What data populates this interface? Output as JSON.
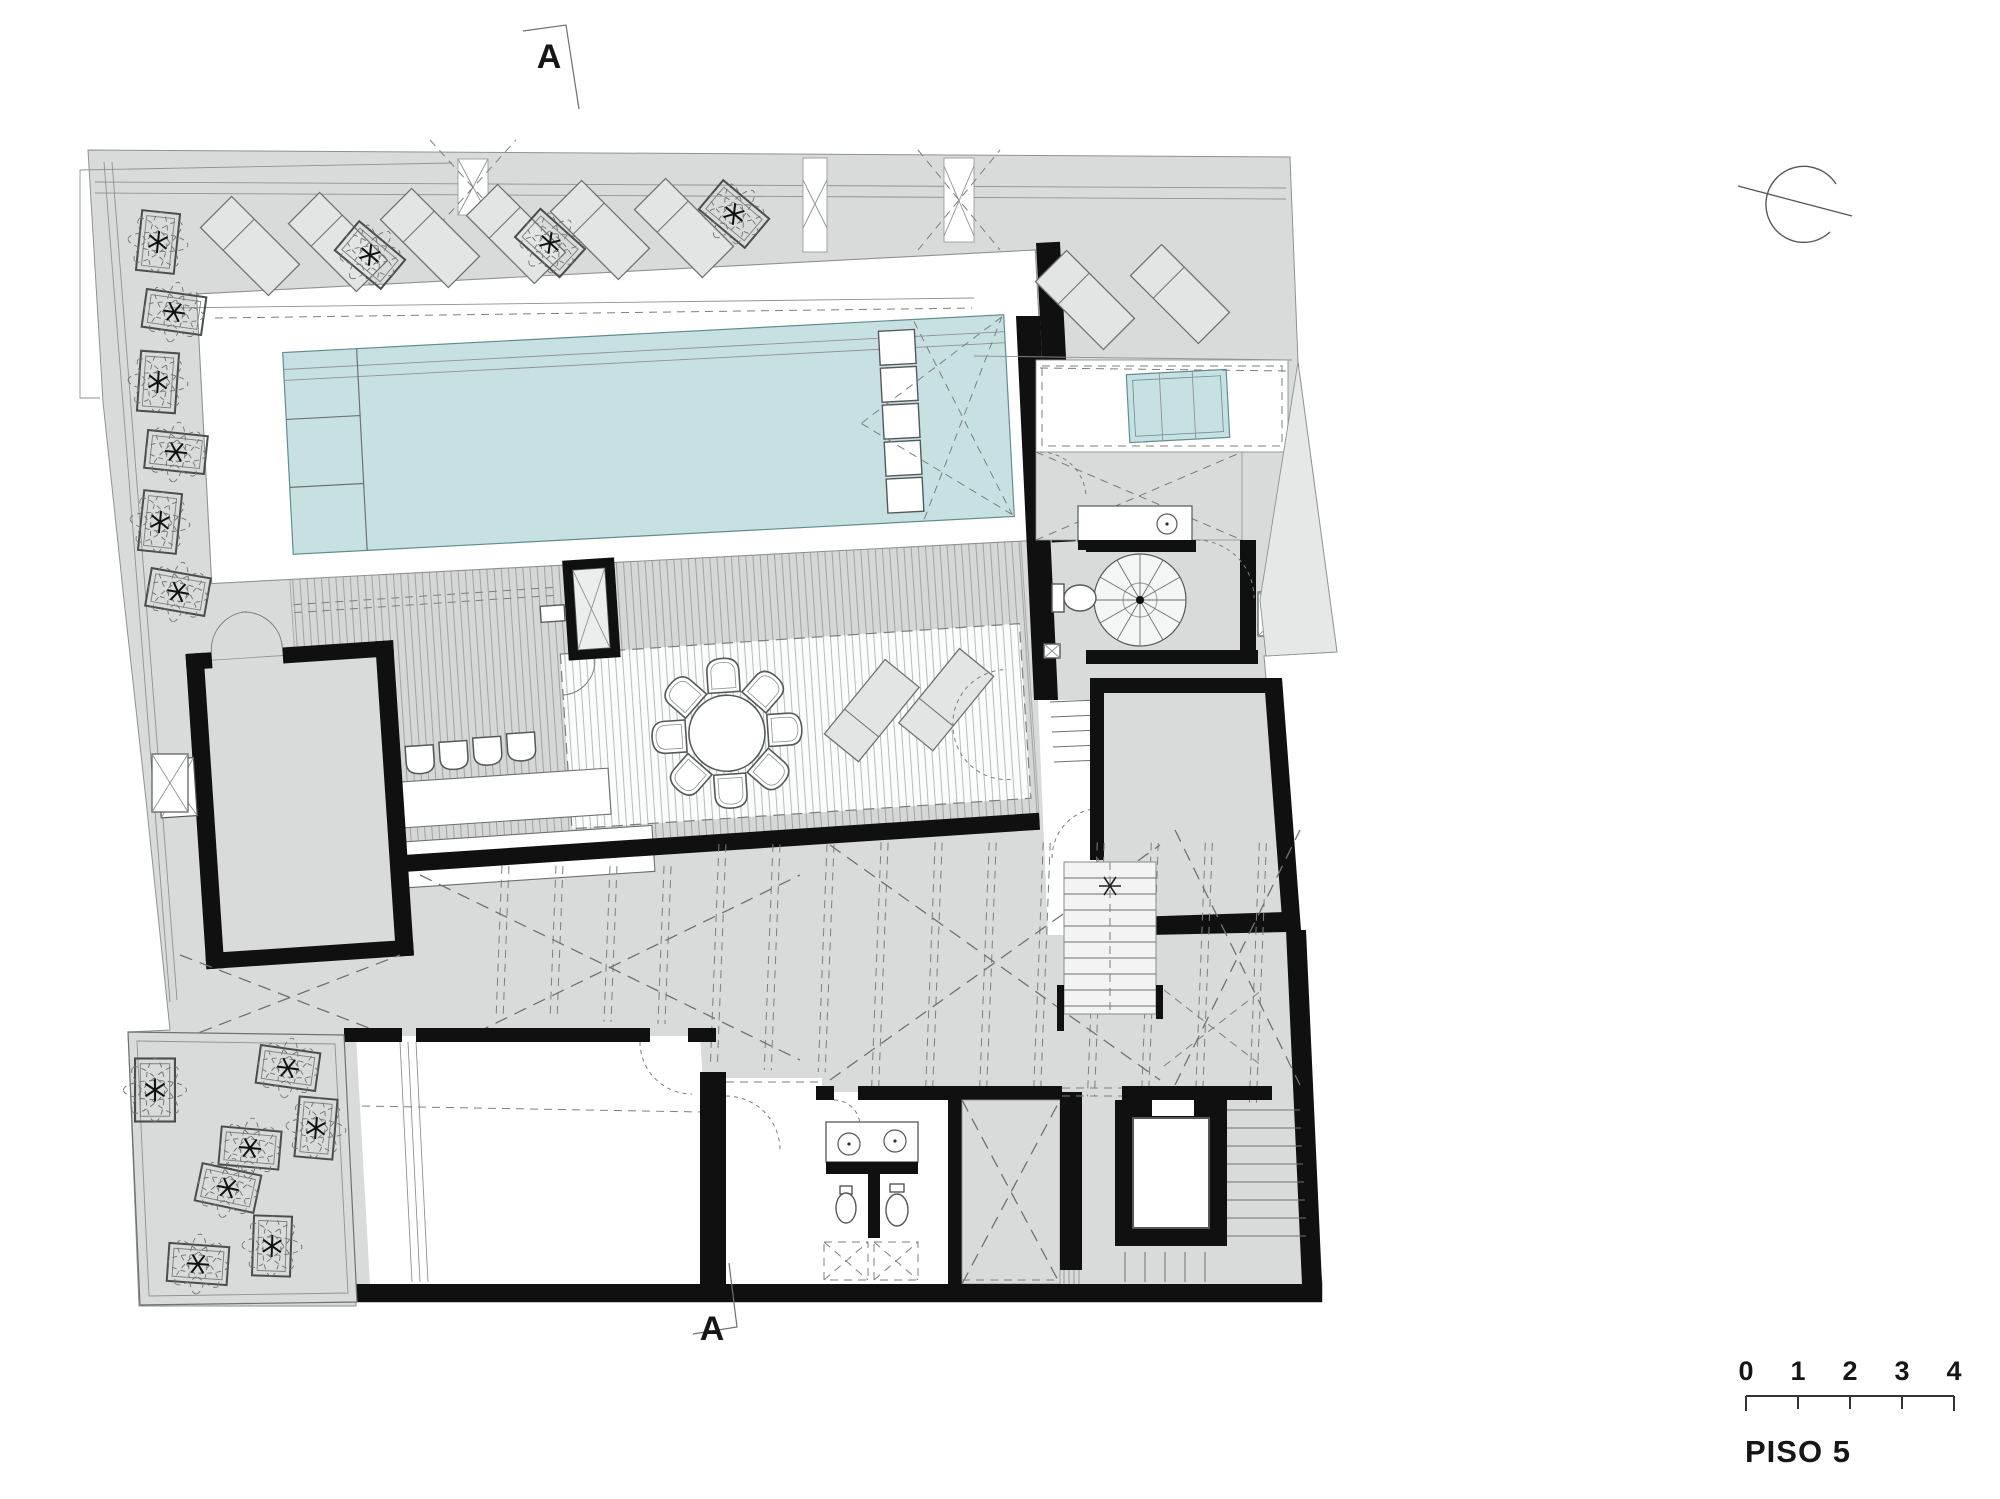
{
  "drawing": {
    "type": "architectural-floor-plan",
    "floor_label": "PISO 5",
    "section_markers": {
      "top": "A",
      "bottom": "A"
    },
    "scale_bar": {
      "labels": [
        "0",
        "1",
        "2",
        "3",
        "4"
      ],
      "floor_label": "PISO 5"
    },
    "icons": {
      "north_indicator": "open-circle-with-diagonal-line",
      "plants": "planter-box-with-star-foliage",
      "spiral_stair": "spiral-staircase",
      "elevator": "elevator-shaft",
      "pool": "lap-pool-with-ladder-and-steps"
    },
    "colors": {
      "terrace_gray": "#d9dbda",
      "pool_cyan": "#c7e1e3",
      "wall_black": "#101010",
      "line_gray": "#6e7170",
      "background": "#ffffff"
    }
  }
}
